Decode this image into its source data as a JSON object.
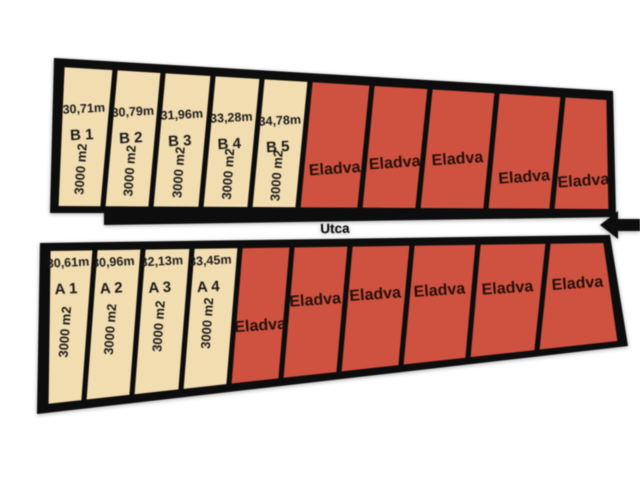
{
  "map": {
    "title": "site-plan",
    "street": {
      "label": "Utca"
    },
    "arrow": {
      "icon": "arrow-left-icon"
    },
    "colors": {
      "available_fill": "#f2ddb0",
      "sold_fill": "#cf513f",
      "outline": "#0d0d0d",
      "street_fill": "#ffffff",
      "lot_text": "#1a1a1a",
      "sold_text": "#24100a"
    },
    "rows": {
      "top": {
        "plots": [
          {
            "status": "available",
            "id": "B 1",
            "width_label": "30,71m",
            "area_label": "3000 m2"
          },
          {
            "status": "available",
            "id": "B 2",
            "width_label": "30,79m",
            "area_label": "3000 m2"
          },
          {
            "status": "available",
            "id": "B 3",
            "width_label": "31,96m",
            "area_label": "3000 m2"
          },
          {
            "status": "available",
            "id": "B 4",
            "width_label": "33,28m",
            "area_label": "3000 m2"
          },
          {
            "status": "available",
            "id": "B 5",
            "width_label": "34,78m",
            "area_label": "3000 m2"
          },
          {
            "status": "sold",
            "label": "Eladva"
          },
          {
            "status": "sold",
            "label": "Eladva"
          },
          {
            "status": "sold",
            "label": "Eladva"
          },
          {
            "status": "sold",
            "label": "Eladva"
          },
          {
            "status": "sold",
            "label": "Eladva"
          }
        ]
      },
      "bottom": {
        "plots": [
          {
            "status": "available",
            "id": "A 1",
            "width_label": "30,61m",
            "area_label": "3000 m2"
          },
          {
            "status": "available",
            "id": "A 2",
            "width_label": "30,96m",
            "area_label": "3000 m2"
          },
          {
            "status": "available",
            "id": "A 3",
            "width_label": "32,13m",
            "area_label": "3000 m2"
          },
          {
            "status": "available",
            "id": "A 4",
            "width_label": "33,45m",
            "area_label": "3000 m2"
          },
          {
            "status": "sold",
            "label": "Eladva"
          },
          {
            "status": "sold",
            "label": "Eladva"
          },
          {
            "status": "sold",
            "label": "Eladva"
          },
          {
            "status": "sold",
            "label": "Eladva"
          },
          {
            "status": "sold",
            "label": "Eladva"
          },
          {
            "status": "sold",
            "label": "Eladva"
          }
        ]
      }
    }
  }
}
